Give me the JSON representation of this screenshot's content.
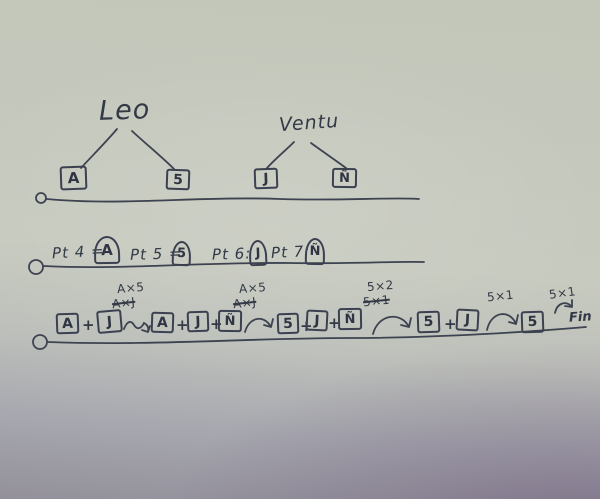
{
  "labels": {
    "plus": "+"
  },
  "trees": [
    {
      "name": "Leo",
      "children": [
        "A",
        "5"
      ]
    },
    {
      "name": "Ventu",
      "children": [
        "J",
        "Ñ"
      ]
    }
  ],
  "points": [
    {
      "text": "Pt 4 =",
      "symbol": "A"
    },
    {
      "text": "Pt 5 =",
      "symbol": "5"
    },
    {
      "text": "Pt 6:",
      "symbol": "J"
    },
    {
      "text": "Pt 7:",
      "symbol": "Ñ"
    }
  ],
  "sequence": {
    "terms": [
      {
        "boxes": [
          "A",
          "J"
        ]
      },
      {
        "boxes": [
          "A",
          "J",
          "Ñ"
        ]
      },
      {
        "boxes": [
          "5",
          "J",
          "Ñ"
        ]
      },
      {
        "boxes": [
          "5",
          "J"
        ]
      },
      {
        "boxes": [
          "5"
        ]
      }
    ],
    "arrows": [
      {
        "label": "A×5",
        "crossed": "A×J"
      },
      {
        "label": "A×5",
        "crossed": "A×J"
      },
      {
        "label": "5×2",
        "crossed": "5×1"
      },
      {
        "label": "5×1",
        "crossed": ""
      },
      {
        "label": "5×1",
        "crossed": ""
      }
    ],
    "end": "Fin"
  },
  "colors": {
    "ink": "#3b4150",
    "paper_top": "#c3c8bc",
    "paper_bottom": "#8e8495"
  }
}
